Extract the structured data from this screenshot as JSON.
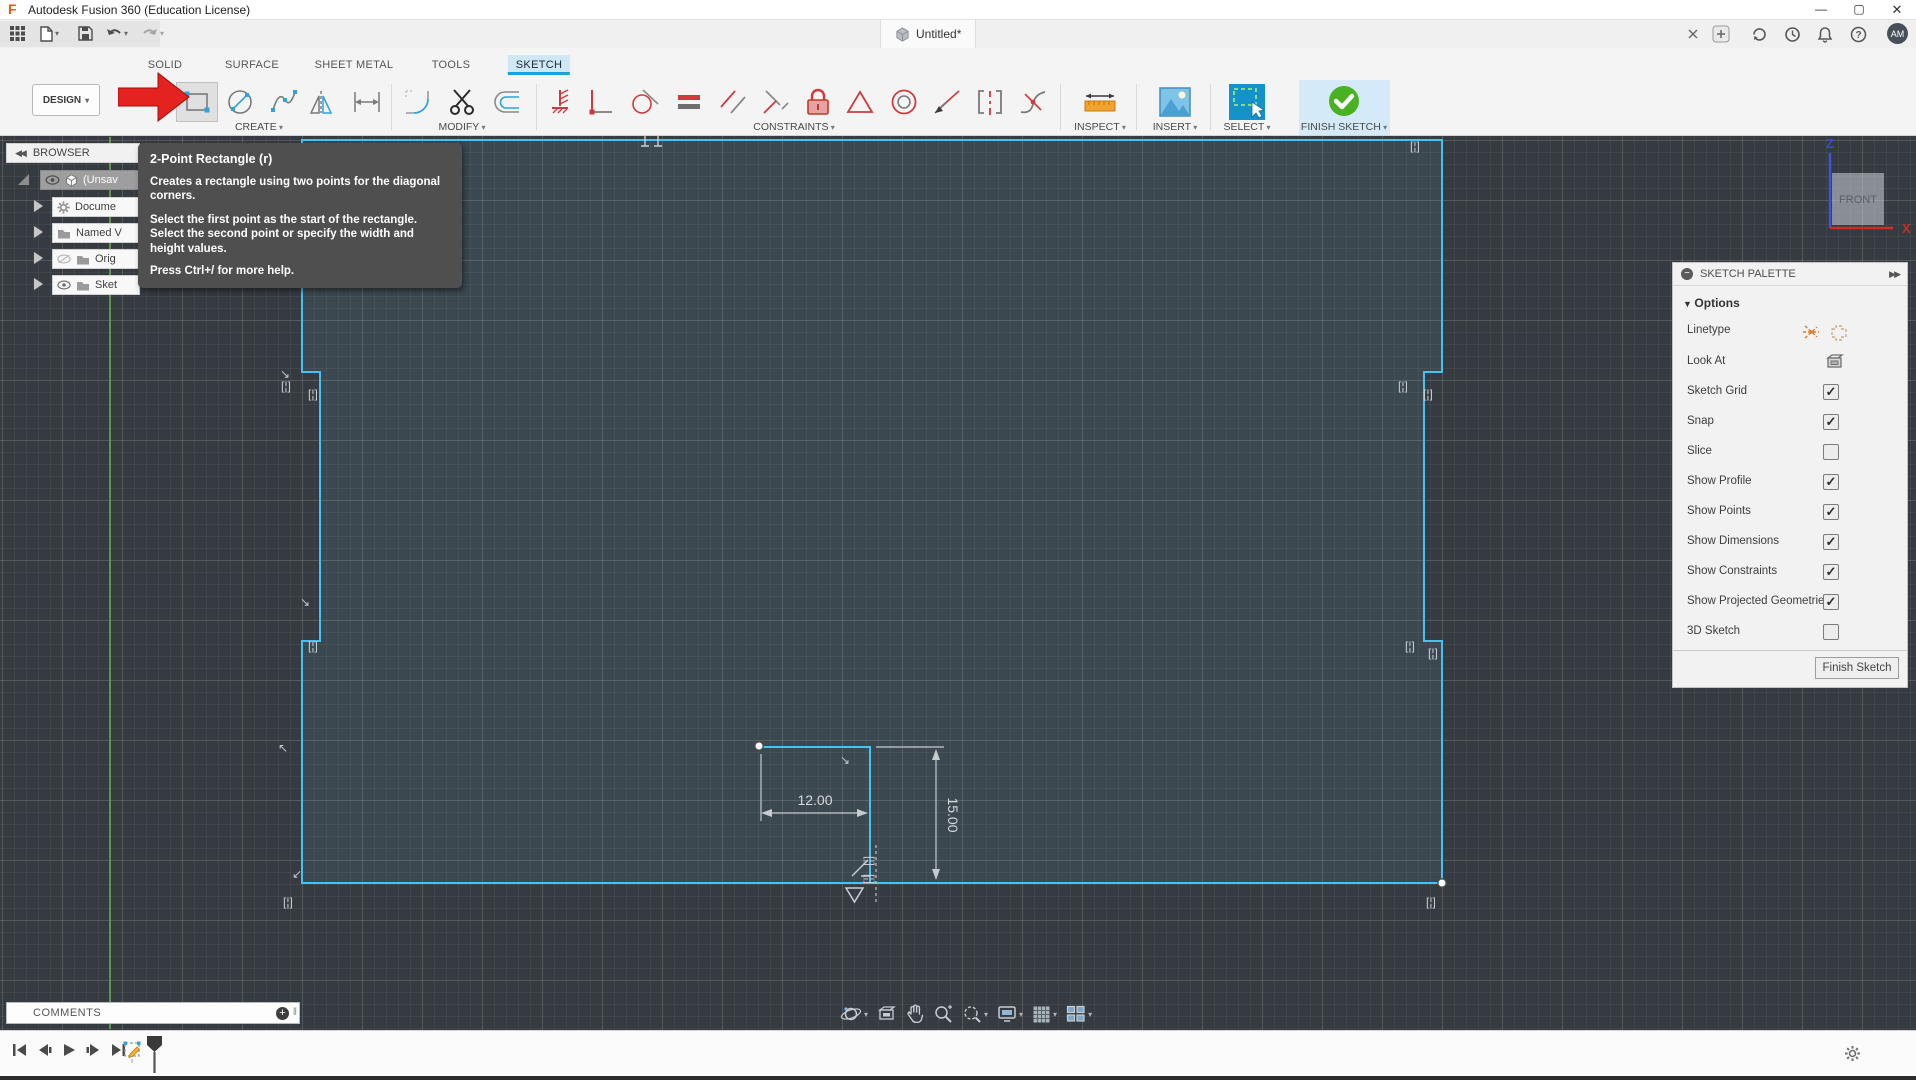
{
  "window": {
    "title": "Autodesk Fusion 360 (Education License)"
  },
  "topbar": {
    "doc_tab": "Untitled*",
    "avatar_initials": "AM"
  },
  "workspace": {
    "label": "DESIGN"
  },
  "ribbon": {
    "tabs": [
      {
        "label": "SOLID"
      },
      {
        "label": "SURFACE"
      },
      {
        "label": "SHEET METAL"
      },
      {
        "label": "TOOLS"
      },
      {
        "label": "SKETCH"
      }
    ],
    "active_tab": "SKETCH",
    "groups": [
      {
        "label": "CREATE"
      },
      {
        "label": "MODIFY"
      },
      {
        "label": "CONSTRAINTS"
      },
      {
        "label": "INSPECT"
      },
      {
        "label": "INSERT"
      },
      {
        "label": "SELECT"
      },
      {
        "label": "FINISH SKETCH"
      }
    ]
  },
  "tooltip": {
    "title": "2-Point Rectangle (r)",
    "body1": "Creates a rectangle using two points for the diagonal corners.",
    "body2": "Select the first point as the start of the rectangle. Select the second point or specify the width and height values.",
    "footer": "Press Ctrl+/ for more help."
  },
  "browser": {
    "header": "BROWSER",
    "items": [
      {
        "label": "(Unsav"
      },
      {
        "label": "Docume"
      },
      {
        "label": "Named V"
      },
      {
        "label": "Orig"
      },
      {
        "label": "Sket"
      }
    ]
  },
  "palette": {
    "header": "SKETCH PALETTE",
    "section": "Options",
    "rows": [
      {
        "label": "Linetype",
        "type": "linetype"
      },
      {
        "label": "Look At",
        "type": "lookat"
      },
      {
        "label": "Sketch Grid",
        "checked": "true"
      },
      {
        "label": "Snap",
        "checked": "true"
      },
      {
        "label": "Slice",
        "checked": "false"
      },
      {
        "label": "Show Profile",
        "checked": "true"
      },
      {
        "label": "Show Points",
        "checked": "true"
      },
      {
        "label": "Show Dimensions",
        "checked": "true"
      },
      {
        "label": "Show Constraints",
        "checked": "true"
      },
      {
        "label": "Show Projected Geometries",
        "checked": "true"
      },
      {
        "label": "3D Sketch",
        "checked": "false"
      }
    ],
    "finish_button": "Finish Sketch"
  },
  "sketch": {
    "dim_width": "12.00",
    "dim_height": "15.00",
    "glyphs": {
      "bracket": "[¦]",
      "arrow_se": "↘",
      "arrow_nw": "↖",
      "arrow_sw": "↙"
    }
  },
  "viewcube": {
    "face": "FRONT",
    "axis_z": "Z",
    "axis_x": "X"
  },
  "comments": {
    "label": "COMMENTS"
  },
  "colors": {
    "accent_blue": "#1da1dd",
    "sketch_line": "#45c2f0",
    "arrow_red": "#e42320",
    "finish_green": "#49b222",
    "axis_green": "#63b44f",
    "inspect_orange": "#f0a028"
  }
}
